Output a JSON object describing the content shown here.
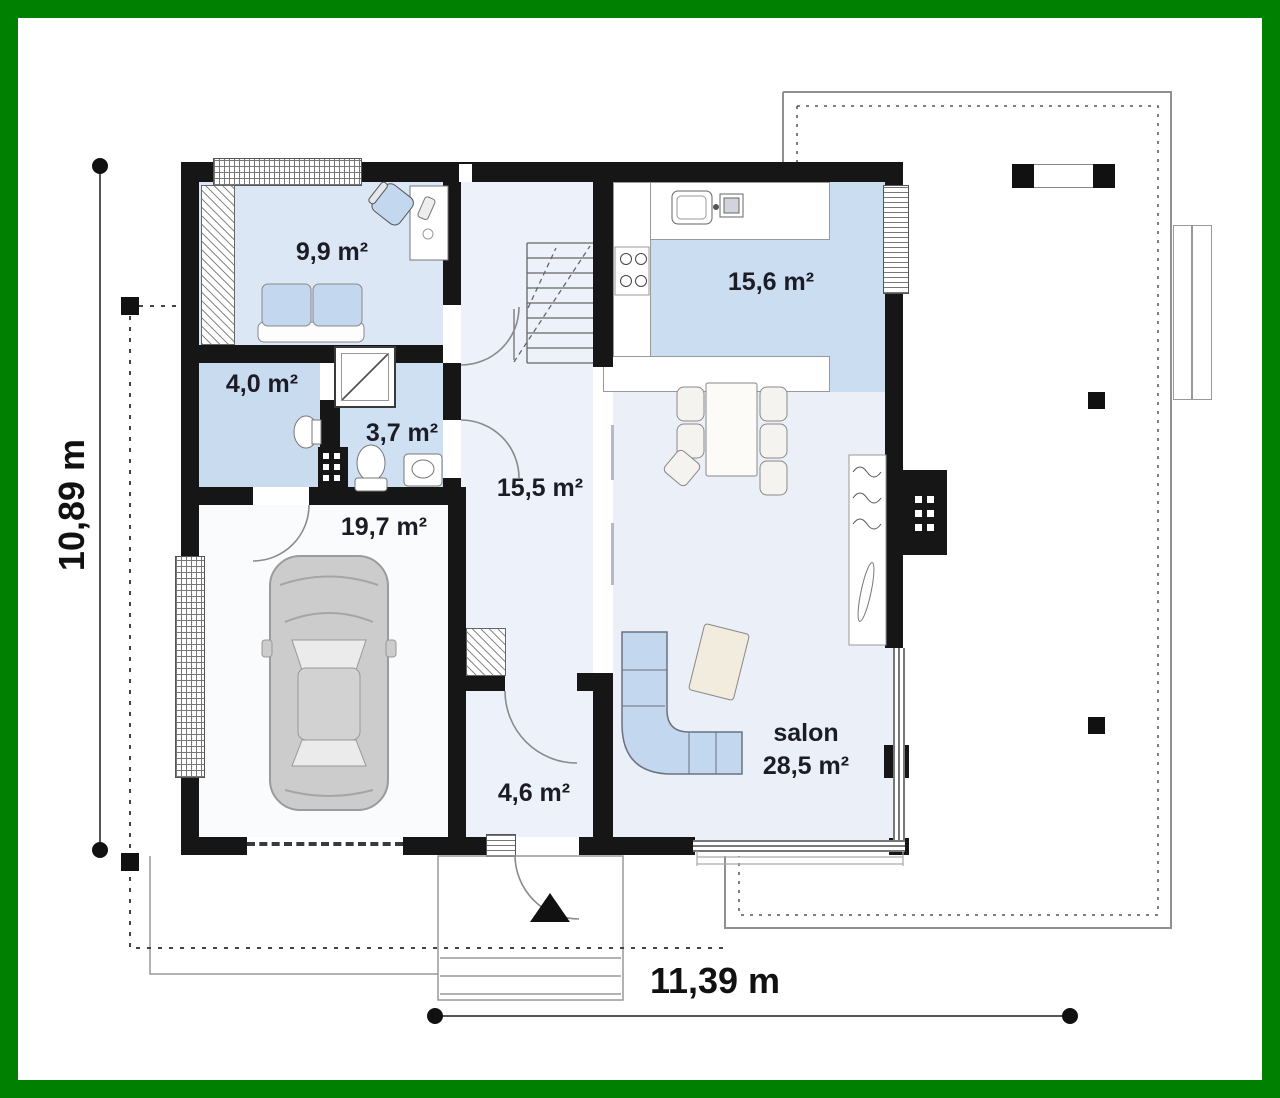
{
  "floorplan": {
    "frame_color": "#008000",
    "dimensions": {
      "left": "10,89 m",
      "bottom": "11,39 m"
    },
    "rooms": {
      "study": "9,9 m²",
      "utility": "4,0 m²",
      "bathroom": "3,7 m²",
      "hall": "15,5 m²",
      "garage": "19,7 m²",
      "kitchen": "15,6 m²",
      "entry": "4,6 m²",
      "salon_name": "salon",
      "salon_area": "28,5 m²"
    },
    "colors": {
      "wall": "#161616",
      "room_shaded": "#cbdcf0",
      "room_shaded_light": "#dce7f5",
      "room_pale": "#ecf1f9",
      "furniture_blue": "#c3d7ee",
      "text": "#1c1c26"
    }
  }
}
